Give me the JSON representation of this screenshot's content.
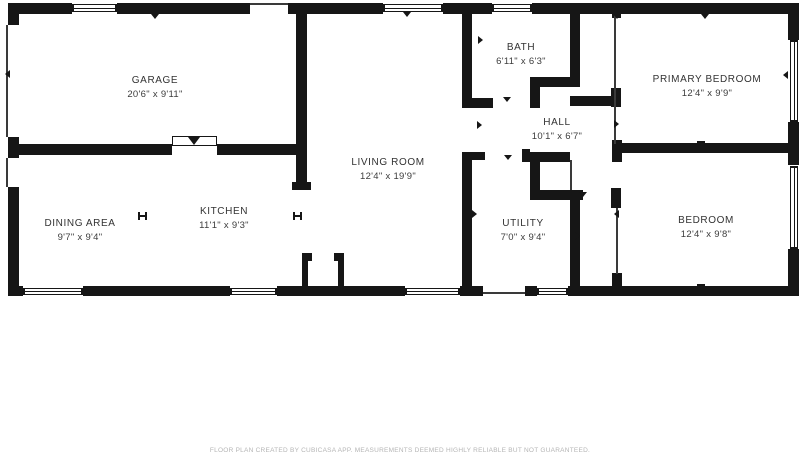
{
  "floor_plan": {
    "rooms": [
      {
        "id": "garage",
        "name": "GARAGE",
        "dimensions": "20'6\" x 9'11\""
      },
      {
        "id": "living-room",
        "name": "LIVING ROOM",
        "dimensions": "12'4\" x 19'9\""
      },
      {
        "id": "bath",
        "name": "BATH",
        "dimensions": "6'11\" x 6'3\""
      },
      {
        "id": "hall",
        "name": "HALL",
        "dimensions": "10'1\" x 6'7\""
      },
      {
        "id": "primary-bedroom",
        "name": "PRIMARY BEDROOM",
        "dimensions": "12'4\" x 9'9\""
      },
      {
        "id": "utility",
        "name": "UTILITY",
        "dimensions": "7'0\" x 9'4\""
      },
      {
        "id": "bedroom",
        "name": "BEDROOM",
        "dimensions": "12'4\" x 9'8\""
      },
      {
        "id": "dining-area",
        "name": "DINING AREA",
        "dimensions": "9'7\" x 9'4\""
      },
      {
        "id": "kitchen",
        "name": "KITCHEN",
        "dimensions": "11'1\" x 9'3\""
      }
    ],
    "footer": "FLOOR PLAN CREATED BY CUBICASA APP. MEASUREMENTS DEEMED HIGHLY RELIABLE BUT NOT GUARANTEED."
  }
}
